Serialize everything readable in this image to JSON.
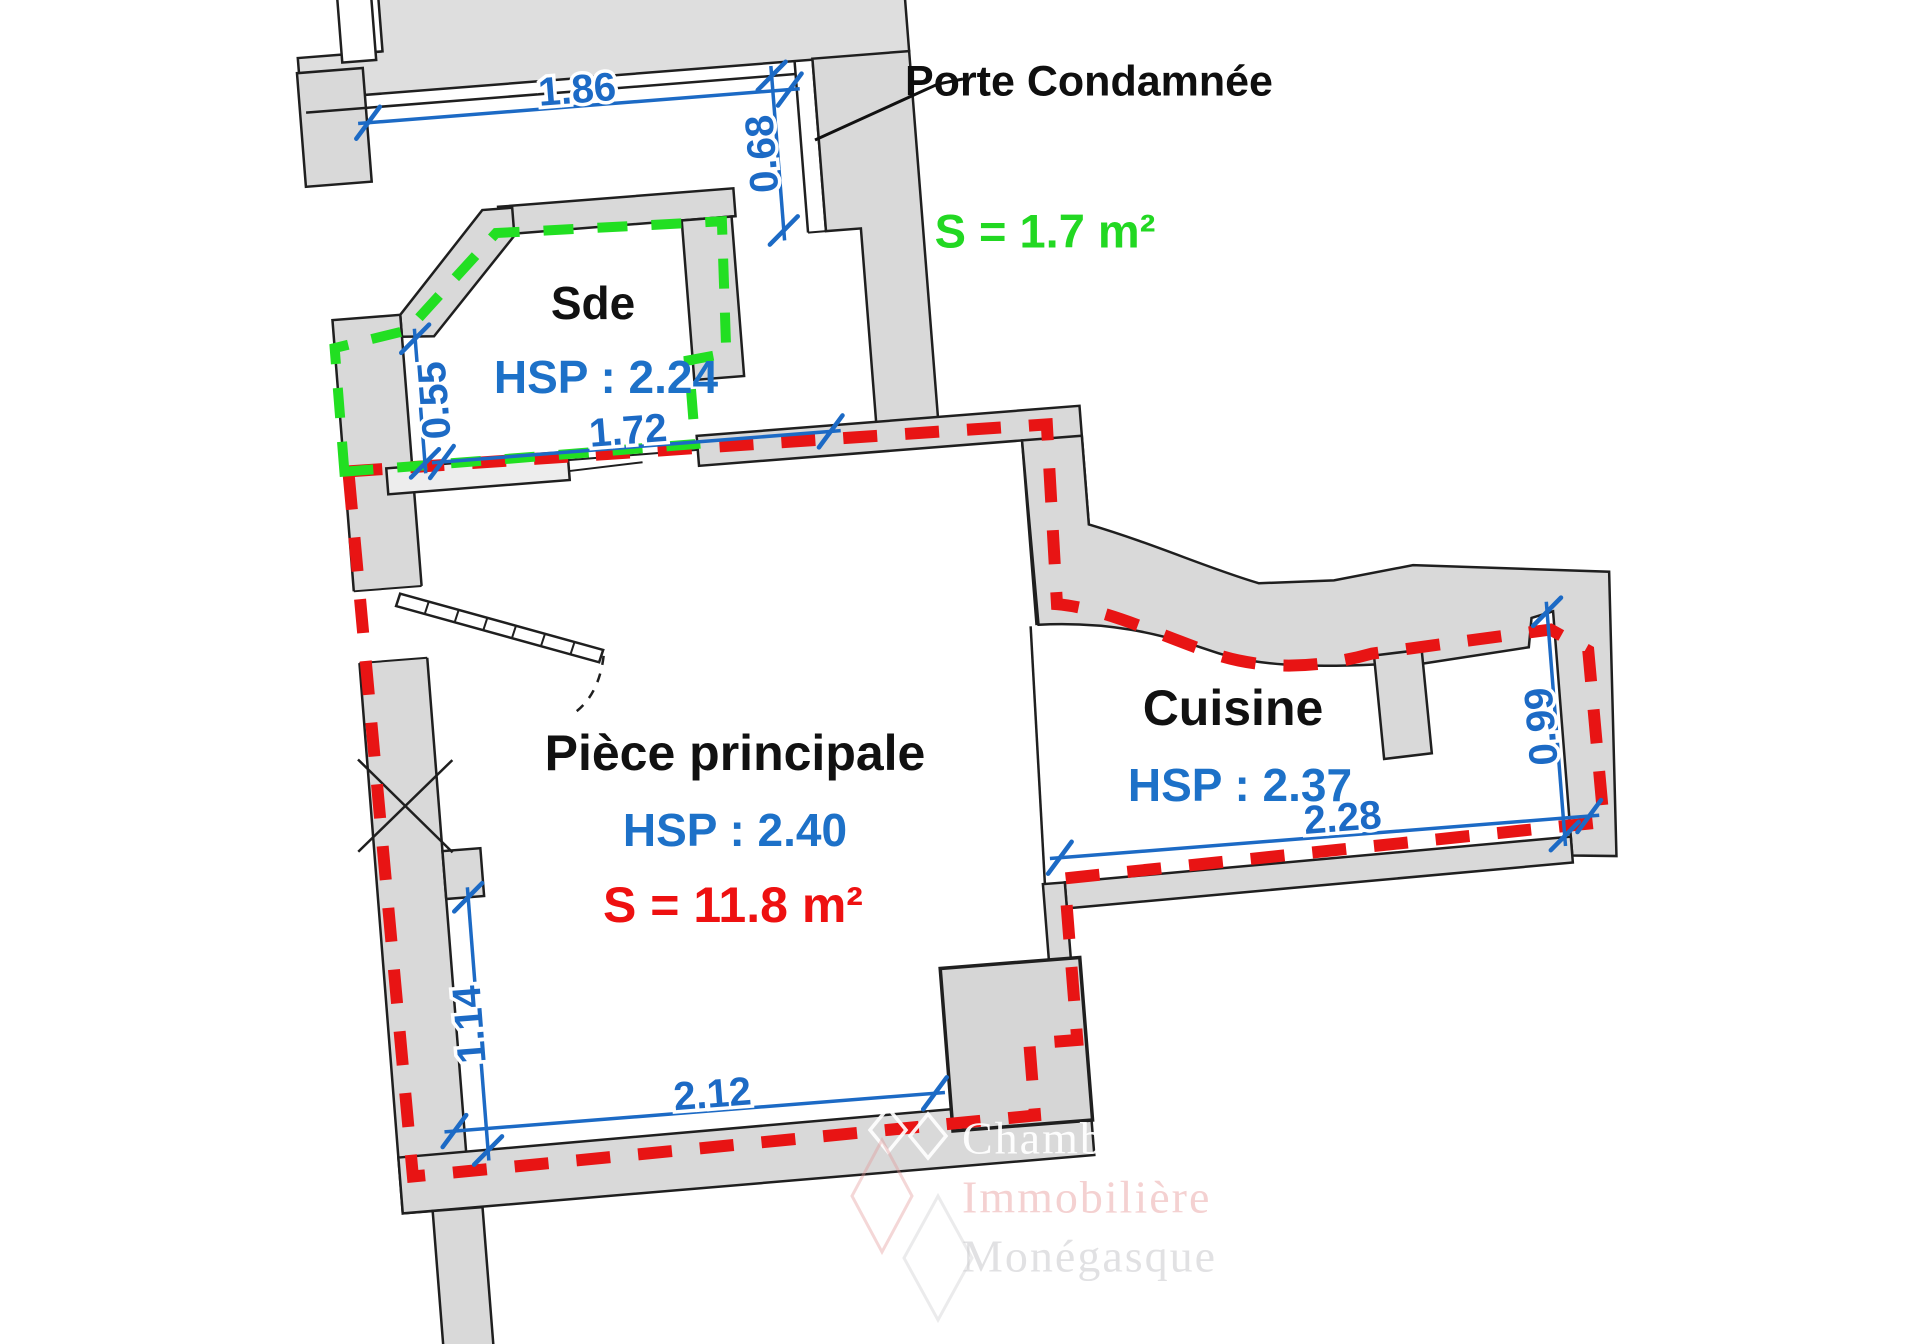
{
  "plan_type": "floor-plan",
  "rooms": [
    {
      "id": "sde",
      "name": "Sde",
      "hsp_label": "HSP : 2.24",
      "area_label": "S = 1.7 m²"
    },
    {
      "id": "piece-principale",
      "name": "Pièce principale",
      "hsp_label": "HSP : 2.40",
      "area_label": "S = 11.8 m²"
    },
    {
      "id": "cuisine",
      "name": "Cuisine",
      "hsp_label": "HSP : 2.37"
    }
  ],
  "annotations": {
    "condemned_door_label": "Porte Condamnée"
  },
  "dimensions_m": {
    "top_wall": "1.86",
    "condemned_door": "0.68",
    "sde_width": "1.72",
    "sde_left_height": "0.55",
    "pp_left_height": "1.14",
    "pp_bottom_width": "2.12",
    "cuisine_bottom_width": "2.28",
    "cuisine_right_height": "0.99"
  },
  "colors": {
    "dimension_blue": "#1c6ac5",
    "hsp_blue": "#1d71c8",
    "perimeter_red": "#e81414",
    "area_red": "#ee1111",
    "sde_green": "#22df22",
    "area_green": "#22d822",
    "wall_gray": "#d9d9d9",
    "label_black": "#111111"
  },
  "watermark": {
    "line1": "Chambre",
    "line2": "Immobilière",
    "line3": "Monégasque"
  }
}
